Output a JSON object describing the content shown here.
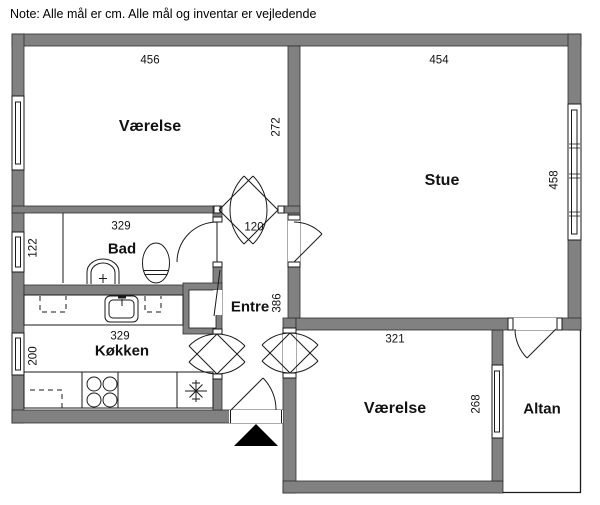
{
  "note": "Note: Alle mål er cm. Alle mål og inventar er vejledende",
  "colors": {
    "wall_fill": "#818181",
    "line": "#1a1a1a",
    "background": "#ffffff",
    "entrance_arrow": "#000000"
  },
  "rooms": {
    "vaerelse_top": {
      "name": "Værelse",
      "width_cm": "456",
      "depth_cm": "272"
    },
    "stue": {
      "name": "Stue",
      "width_cm": "454",
      "depth_cm": "458"
    },
    "bad": {
      "name": "Bad",
      "width_cm": "329",
      "depth_cm": "122"
    },
    "entre": {
      "name": "Entre",
      "passage_width_cm": "120",
      "depth_cm": "386"
    },
    "koekken": {
      "name": "Køkken",
      "width_cm": "329",
      "depth_cm": "200"
    },
    "vaerelse_bottom": {
      "name": "Værelse",
      "width_cm": "321",
      "depth_cm": "268"
    },
    "altan": {
      "name": "Altan"
    }
  }
}
